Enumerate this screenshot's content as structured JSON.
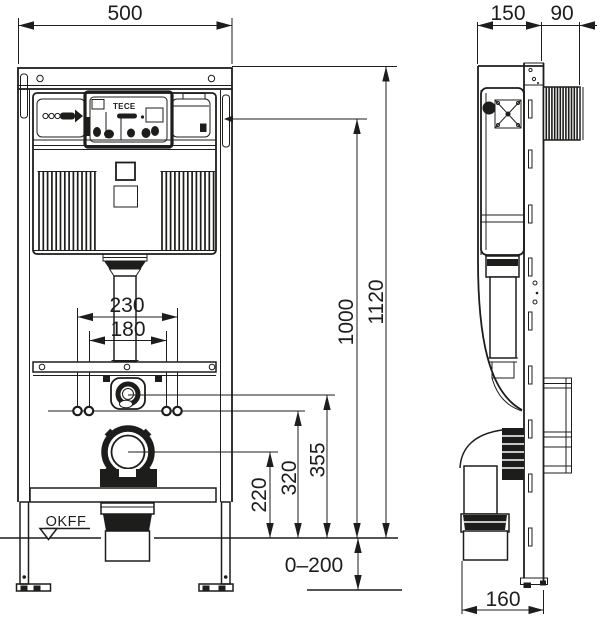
{
  "colors": {
    "line": "#1d1d1b",
    "background": "#ffffff"
  },
  "front_view": {
    "dimensions": {
      "width": "500",
      "anchor_spacing_outer": "230",
      "anchor_spacing_inner": "180",
      "height_total": "1120",
      "height_upper": "1000",
      "height_flush_pipe": "355",
      "height_anchors": "320",
      "height_outlet": "220",
      "leg_adjustment": "0–200"
    },
    "labels": {
      "floor_level": "OKFF",
      "brand": "TECE"
    }
  },
  "side_view": {
    "dimensions": {
      "depth_frame": "150",
      "depth_pipe_zone": "90",
      "outlet_offset": "160"
    }
  }
}
